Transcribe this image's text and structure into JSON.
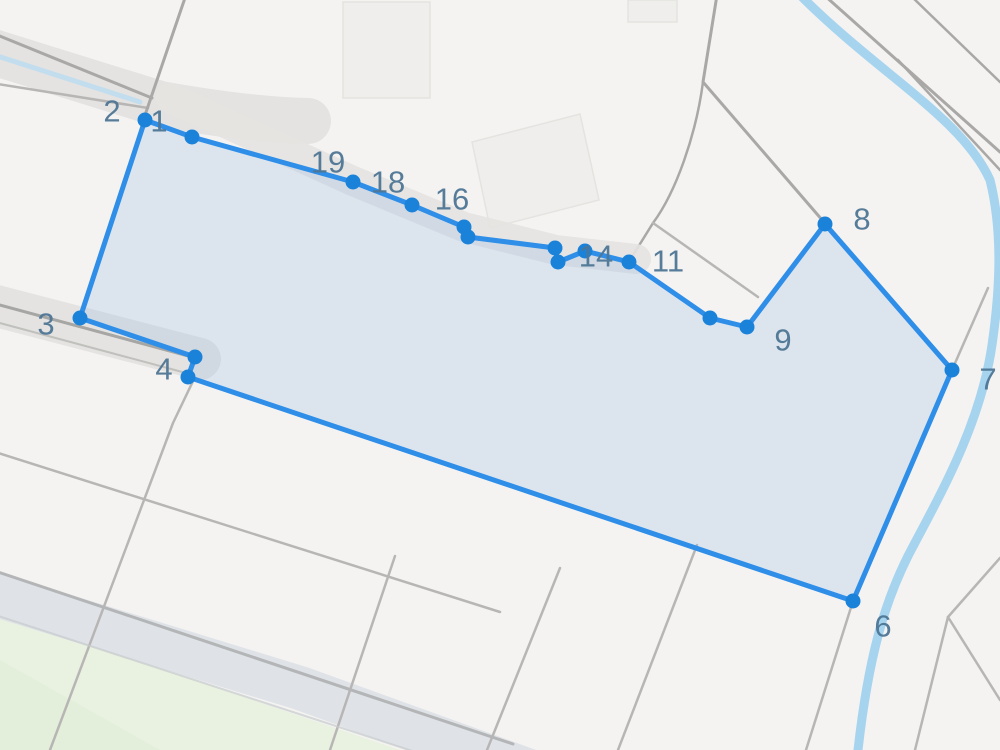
{
  "map": {
    "width": 1000,
    "height": 750,
    "background": "#f4f3f1",
    "palette": {
      "parcel_line": "#b7b6b4",
      "road_line": "#a9a8a6",
      "road_band": "#e4e3e1",
      "road_band_bottom": "#dfe3e8",
      "stream": "#a6d4ef",
      "stream_faint": "#c2ddee",
      "green": "#e9f1e1",
      "green_deep": "#e0eed6",
      "building_fill": "#efeeec",
      "building_stroke": "#e4e3e0",
      "polygon_fill": "rgba(150,190,230,0.26)",
      "polygon_stroke": "#2f8ee8",
      "vertex_fill": "#1b82da",
      "label_color": "#4e7695"
    },
    "label_font_size": 31,
    "greens": [
      {
        "name": "field-green",
        "points": "0,614 400,750 0,750",
        "color": "green"
      },
      {
        "name": "field-green-deep",
        "points": "0,660 160,750 0,750",
        "color": "green_deep",
        "opacity": 0.6
      }
    ],
    "buildings": [
      {
        "name": "building",
        "d": "M343,2 L430,2 L430,98 L343,98 Z"
      },
      {
        "name": "building",
        "d": "M472,142 L580,114 L599,200 L490,228 Z"
      },
      {
        "name": "building",
        "d": "M628,0 L677,0 L677,22 L628,22 Z"
      }
    ],
    "bands": [
      {
        "name": "road-band-topleft",
        "d": "M-20,48 L160,104 Q250,120 308,121",
        "w": 46,
        "color": "road_band"
      },
      {
        "name": "road-band-left",
        "d": "M-15,303 L200,359",
        "w": 42,
        "color": "road_band"
      },
      {
        "name": "road-band-bottom",
        "d": "M-20,590 L300,688 L560,782",
        "w": 44,
        "color": "road_band_bottom"
      }
    ],
    "lines": [
      {
        "name": "road-edge",
        "d": "M-15,30 L152,98",
        "w": 3,
        "color": "road_line"
      },
      {
        "name": "road-edge",
        "d": "M-15,82 L148,108",
        "w": 2.5,
        "color": "parcel_line"
      },
      {
        "name": "road",
        "d": "M186,-5 L143,121",
        "w": 3,
        "color": "road_line"
      },
      {
        "name": "road-center",
        "d": "M-15,301 L192,357",
        "w": 3,
        "color": "#a6a6a4"
      },
      {
        "name": "road-edge",
        "d": "M-15,319 L186,373",
        "w": 2,
        "color": "parcel_line",
        "opacity": 0.8
      },
      {
        "name": "parcel-line",
        "d": "M194,379 L173,423 L50,750",
        "w": 2.5,
        "color": "parcel_line"
      },
      {
        "name": "parcel-line",
        "d": "M-5,452 L500,612",
        "w": 2.5,
        "color": "parcel_line"
      },
      {
        "name": "parcel-line",
        "d": "M395,556 L330,750",
        "w": 2.5,
        "color": "parcel_line"
      },
      {
        "name": "parcel-line",
        "d": "M560,568 L487,750",
        "w": 2.5,
        "color": "parcel_line"
      },
      {
        "name": "parcel-line",
        "d": "M697,545 L618,750",
        "w": 2.5,
        "color": "parcel_line"
      },
      {
        "name": "parcel-line",
        "d": "M853,601 L806,750",
        "w": 2.5,
        "color": "parcel_line"
      },
      {
        "name": "parcel-line",
        "d": "M948,617 L915,750",
        "w": 2.5,
        "color": "parcel_line"
      },
      {
        "name": "parcel-line",
        "d": "M948,617 L1000,700",
        "w": 2.5,
        "color": "parcel_line"
      },
      {
        "name": "parcel-line",
        "d": "M948,617 L1000,558",
        "w": 2.5,
        "color": "parcel_line"
      },
      {
        "name": "road-edge",
        "d": "M-20,566 L513,744",
        "w": 3,
        "color": "#b3b5b6"
      },
      {
        "name": "road-edge",
        "d": "M-20,610 L440,760",
        "w": 2,
        "color": "#c6cacc",
        "opacity": 0.7
      },
      {
        "name": "parcel-line",
        "d": "M988,288 L952,370 L916,452",
        "w": 2.5,
        "color": "parcel_line"
      }
    ],
    "streams": [
      {
        "name": "stream-minor",
        "d": "M-15,52 L140,102",
        "w": 5,
        "color": "stream_faint"
      },
      {
        "name": "stream-major",
        "d": "M800,-5 C880,75 962,118 990,180 C1003,232 1000,290 992,345 C980,428 936,502 908,556 C886,600 869,652 858,750",
        "w": 9,
        "color": "stream"
      }
    ],
    "roads": [
      {
        "name": "road",
        "d": "M717,-5 C710,40 706,62 703,82 L823,221",
        "w": 3,
        "color": "road_line"
      },
      {
        "name": "road",
        "d": "M703,82 C696,135 676,192 653,223 L630,260",
        "w": 2.5,
        "color": "road_line"
      },
      {
        "name": "parcel-line",
        "d": "M653,223 L758,297",
        "w": 2.5,
        "color": "parcel_line"
      },
      {
        "name": "road",
        "d": "M824,-5 L1000,152",
        "w": 3,
        "color": "road_line"
      },
      {
        "name": "road",
        "d": "M910,-5 L1000,82",
        "w": 2.5,
        "color": "road_line"
      },
      {
        "name": "road",
        "d": "M898,60 L1000,170",
        "w": 2.5,
        "color": "road_line"
      }
    ],
    "corridors": [
      {
        "name": "track-band-top-edge",
        "d": "M170,98 L353,181 L464,227 L556,250 L636,259",
        "w": 30,
        "color": "road_band",
        "opacity": 0.9
      }
    ],
    "parcel_polygon": {
      "stroke_width": 5,
      "vertex_radius": 7.5,
      "vertices": [
        {
          "x": 192,
          "y": 137,
          "label": "1",
          "lx": 159,
          "ly": 121
        },
        {
          "x": 145,
          "y": 120,
          "label": "2",
          "lx": 112,
          "ly": 111
        },
        {
          "x": 80,
          "y": 318,
          "label": "3",
          "lx": 46,
          "ly": 324
        },
        {
          "x": 195,
          "y": 357,
          "label": "4",
          "lx": 164,
          "ly": 369
        },
        {
          "x": 188,
          "y": 377
        },
        {
          "x": 853,
          "y": 601,
          "label": "6",
          "lx": 883,
          "ly": 626
        },
        {
          "x": 952,
          "y": 370,
          "label": "7",
          "lx": 988,
          "ly": 379
        },
        {
          "x": 825,
          "y": 224,
          "label": "8",
          "lx": 862,
          "ly": 219
        },
        {
          "x": 747,
          "y": 327,
          "label": "9",
          "lx": 783,
          "ly": 340
        },
        {
          "x": 710,
          "y": 318
        },
        {
          "x": 629,
          "y": 262,
          "label": "11",
          "lx": 668,
          "ly": 261
        },
        {
          "x": 585,
          "y": 251
        },
        {
          "x": 558,
          "y": 262
        },
        {
          "x": 555,
          "y": 248,
          "label": "14",
          "lx": 596,
          "ly": 256
        },
        {
          "x": 468,
          "y": 237
        },
        {
          "x": 464,
          "y": 227,
          "label": "16",
          "lx": 452,
          "ly": 199
        },
        {
          "x": 412,
          "y": 205,
          "label": "18",
          "lx": 388,
          "ly": 182
        },
        {
          "x": 353,
          "y": 182,
          "label": "19",
          "lx": 328,
          "ly": 162
        }
      ]
    }
  }
}
